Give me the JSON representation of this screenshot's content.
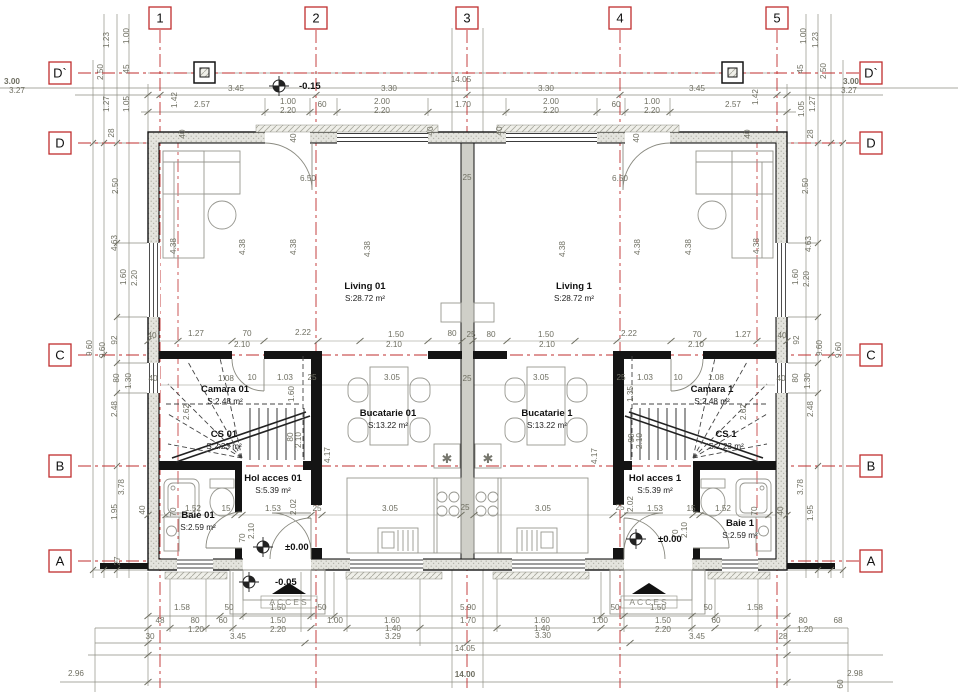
{
  "title": "Ground floor duplex plan",
  "colors": {
    "axis_red": "#bf2e2e",
    "dim_text": "#6f6f62",
    "line_gray": "#8f8f84",
    "wall_black": "#141414",
    "wall_fill": "#e4e4de",
    "furniture": "#979790"
  },
  "grid_axes": {
    "vertical": [
      {
        "label": "1",
        "x": 160
      },
      {
        "label": "2",
        "x": 316
      },
      {
        "label": "3",
        "x": 467
      },
      {
        "label": "4",
        "x": 620
      },
      {
        "label": "5",
        "x": 777
      }
    ],
    "horizontal": [
      {
        "label": "D`",
        "y": 73
      },
      {
        "label": "D",
        "y": 143
      },
      {
        "label": "C",
        "y": 355
      },
      {
        "label": "B",
        "y": 466
      },
      {
        "label": "A",
        "y": 561
      }
    ]
  },
  "rooms": [
    {
      "name": "Living 01",
      "area": "S:28.72 m²",
      "x": 365,
      "y": 289
    },
    {
      "name": "Living 1",
      "area": "S:28.72 m²",
      "x": 574,
      "y": 289
    },
    {
      "name": "Bucatarie 01",
      "area": "S:13.22 m²",
      "x": 388,
      "y": 416
    },
    {
      "name": "Bucatarie 1",
      "area": "S:13.22 m²",
      "x": 547,
      "y": 416
    },
    {
      "name": "Camara 01",
      "area": "S:2.48 m²",
      "x": 225,
      "y": 392
    },
    {
      "name": "Camara 1",
      "area": "S:2.48 m²",
      "x": 712,
      "y": 392
    },
    {
      "name": "CS 01",
      "area": "S:2.23 m²",
      "x": 224,
      "y": 437
    },
    {
      "name": "CS 1",
      "area": "S:2.23 m²",
      "x": 726,
      "y": 437
    },
    {
      "name": "Hol acces 01",
      "area": "S:5.39 m²",
      "x": 273,
      "y": 481
    },
    {
      "name": "Hol acces 1",
      "area": "S:5.39 m²",
      "x": 655,
      "y": 481
    },
    {
      "name": "Baie 01",
      "area": "S:2.59 m²",
      "x": 198,
      "y": 518
    },
    {
      "name": "Baie 1",
      "area": "S:2.59 m²",
      "x": 740,
      "y": 526
    }
  ],
  "levels": [
    {
      "label": "-0.15",
      "x": 299,
      "y": 89,
      "mx": 279,
      "my": 86
    },
    {
      "label": "±0.00",
      "x": 285,
      "y": 550,
      "mx": 263,
      "my": 547
    },
    {
      "label": "±0.00",
      "x": 658,
      "y": 542,
      "mx": 636,
      "my": 539
    },
    {
      "label": "-0.05",
      "x": 275,
      "y": 585,
      "mx": 249,
      "my": 582
    }
  ],
  "access_markers": [
    {
      "label": "ACCES",
      "x": 289,
      "y": 583
    },
    {
      "label": "ACCES",
      "x": 649,
      "y": 583
    }
  ],
  "dims": [
    [
      "3.00",
      12,
      84,
      "b"
    ],
    [
      "3.27",
      17,
      93
    ],
    [
      "3.45",
      236,
      91
    ],
    [
      "3.30",
      389,
      91
    ],
    [
      "14.05",
      461,
      82
    ],
    [
      "3.30",
      546,
      91
    ],
    [
      "3.45",
      697,
      91
    ],
    [
      "3.00",
      851,
      84,
      "b"
    ],
    [
      "3.27",
      849,
      93
    ],
    [
      "2.57",
      202,
      107
    ],
    [
      "1.00",
      288,
      104
    ],
    [
      "2.20",
      288,
      113
    ],
    [
      "60",
      322,
      107
    ],
    [
      "2.00",
      382,
      104
    ],
    [
      "2.20",
      382,
      113
    ],
    [
      "1.70",
      463,
      107
    ],
    [
      "2.00",
      551,
      104
    ],
    [
      "2.20",
      551,
      113
    ],
    [
      "60",
      616,
      107
    ],
    [
      "1.00",
      652,
      104
    ],
    [
      "2.20",
      652,
      113
    ],
    [
      "2.57",
      733,
      107
    ],
    [
      "1.42",
      177,
      100,
      "r"
    ],
    [
      "1.42",
      758,
      97,
      "r"
    ],
    [
      "1.00",
      129,
      36,
      "r"
    ],
    [
      "1.23",
      109,
      40,
      "r"
    ],
    [
      "45",
      129,
      69,
      "r"
    ],
    [
      "2.50",
      103,
      72,
      "r"
    ],
    [
      "1.27",
      109,
      104,
      "r"
    ],
    [
      "1.05",
      129,
      104,
      "r"
    ],
    [
      "28",
      114,
      133,
      "r"
    ],
    [
      "2.50",
      118,
      186,
      "r"
    ],
    [
      "4.63",
      117,
      243,
      "r"
    ],
    [
      "1.60",
      126,
      277,
      "r"
    ],
    [
      "2.20",
      137,
      278,
      "r"
    ],
    [
      "92",
      117,
      340,
      "r"
    ],
    [
      "9.60",
      92,
      348,
      "r"
    ],
    [
      "9.60",
      105,
      350,
      "r"
    ],
    [
      "80",
      119,
      378,
      "r"
    ],
    [
      "1.30",
      131,
      381,
      "r"
    ],
    [
      "2.48",
      117,
      409,
      "r"
    ],
    [
      "3.78",
      124,
      487,
      "r"
    ],
    [
      "1.95",
      117,
      512,
      "r"
    ],
    [
      "27",
      120,
      561,
      "r"
    ],
    [
      "2.96",
      76,
      676
    ],
    [
      "1.00",
      806,
      36,
      "r"
    ],
    [
      "1.23",
      818,
      40,
      "r"
    ],
    [
      "45",
      803,
      69,
      "r"
    ],
    [
      "2.50",
      826,
      71,
      "r"
    ],
    [
      "1.27",
      815,
      104,
      "r"
    ],
    [
      "1.05",
      804,
      109,
      "r"
    ],
    [
      "28",
      813,
      134,
      "r"
    ],
    [
      "2.50",
      808,
      186,
      "r"
    ],
    [
      "4.63",
      811,
      244,
      "r"
    ],
    [
      "1.60",
      798,
      277,
      "r"
    ],
    [
      "2.20",
      809,
      279,
      "r"
    ],
    [
      "92",
      799,
      340,
      "r"
    ],
    [
      "9.60",
      822,
      348,
      "r"
    ],
    [
      "9.60",
      841,
      350,
      "r"
    ],
    [
      "80",
      798,
      378,
      "r"
    ],
    [
      "1.30",
      810,
      381,
      "r"
    ],
    [
      "2.48",
      813,
      409,
      "r"
    ],
    [
      "3.78",
      803,
      487,
      "r"
    ],
    [
      "1.95",
      813,
      513,
      "r"
    ],
    [
      "2.98",
      855,
      676
    ],
    [
      "60",
      843,
      684,
      "r"
    ],
    [
      "40",
      152,
      338
    ],
    [
      "1.27",
      196,
      336
    ],
    [
      "70",
      247,
      336
    ],
    [
      "2.10",
      242,
      347
    ],
    [
      "2.22",
      303,
      335
    ],
    [
      "1.50",
      396,
      337
    ],
    [
      "2.10",
      394,
      347
    ],
    [
      "80",
      452,
      336
    ],
    [
      "25",
      471,
      337
    ],
    [
      "80",
      491,
      337
    ],
    [
      "1.50",
      546,
      337
    ],
    [
      "2.10",
      547,
      347
    ],
    [
      "2.22",
      629,
      336
    ],
    [
      "70",
      697,
      337
    ],
    [
      "2.10",
      696,
      347
    ],
    [
      "1.27",
      743,
      337
    ],
    [
      "40",
      782,
      338
    ],
    [
      "40",
      153,
      381
    ],
    [
      "1.08",
      226,
      381
    ],
    [
      "10",
      252,
      380
    ],
    [
      "1.03",
      285,
      380
    ],
    [
      "25",
      312,
      380
    ],
    [
      "3.05",
      392,
      380
    ],
    [
      "25",
      467,
      381
    ],
    [
      "3.05",
      541,
      380
    ],
    [
      "25",
      621,
      380
    ],
    [
      "1.03",
      645,
      380
    ],
    [
      "10",
      678,
      380
    ],
    [
      "1.08",
      716,
      380
    ],
    [
      "40",
      781,
      381
    ],
    [
      "1.60",
      294,
      394,
      "r"
    ],
    [
      "1.35",
      633,
      394,
      "r"
    ],
    [
      "2.62",
      189,
      412,
      "r"
    ],
    [
      "2.62",
      746,
      412,
      "r"
    ],
    [
      "80",
      293,
      437,
      "r"
    ],
    [
      "2.10",
      301,
      440,
      "r"
    ],
    [
      "80",
      634,
      438,
      "r"
    ],
    [
      "2.10",
      642,
      441,
      "r"
    ],
    [
      "4.17",
      330,
      455,
      "r"
    ],
    [
      "4.17",
      597,
      456,
      "r"
    ],
    [
      "6.50",
      308,
      181
    ],
    [
      "6.50",
      620,
      181
    ],
    [
      "25",
      467,
      180
    ],
    [
      "4.38",
      176,
      246,
      "r"
    ],
    [
      "4.38",
      245,
      247,
      "r"
    ],
    [
      "4.38",
      296,
      247,
      "r"
    ],
    [
      "4.38",
      370,
      249,
      "r"
    ],
    [
      "4.38",
      565,
      249,
      "r"
    ],
    [
      "4.38",
      640,
      247,
      "r"
    ],
    [
      "4.38",
      691,
      247,
      "r"
    ],
    [
      "4.38",
      759,
      246,
      "r"
    ],
    [
      "40",
      185,
      134,
      "r"
    ],
    [
      "40",
      296,
      138,
      "r"
    ],
    [
      "40",
      433,
      131,
      "r"
    ],
    [
      "40",
      502,
      131,
      "r"
    ],
    [
      "40",
      639,
      138,
      "r"
    ],
    [
      "40",
      750,
      134,
      "r"
    ],
    [
      "40",
      145,
      510,
      "r"
    ],
    [
      "70",
      176,
      512,
      "r"
    ],
    [
      "1.52",
      193,
      511
    ],
    [
      "15",
      226,
      511
    ],
    [
      "1.53",
      273,
      511
    ],
    [
      "2.02",
      296,
      507,
      "r"
    ],
    [
      "25",
      317,
      511
    ],
    [
      "3.05",
      390,
      511
    ],
    [
      "25",
      465,
      510
    ],
    [
      "3.05",
      543,
      511
    ],
    [
      "25",
      620,
      510
    ],
    [
      "2.02",
      633,
      504,
      "r"
    ],
    [
      "1.53",
      655,
      511
    ],
    [
      "15",
      691,
      511
    ],
    [
      "1.52",
      723,
      511
    ],
    [
      "70",
      757,
      511,
      "r"
    ],
    [
      "40",
      783,
      511,
      "r"
    ],
    [
      "70",
      245,
      538,
      "r"
    ],
    [
      "2.10",
      254,
      531,
      "r"
    ],
    [
      "70",
      678,
      534,
      "r"
    ],
    [
      "2.10",
      687,
      530,
      "r"
    ],
    [
      "1.58",
      182,
      610
    ],
    [
      "50",
      229,
      610
    ],
    [
      "1.50",
      278,
      610
    ],
    [
      "50",
      322,
      610
    ],
    [
      "5.90",
      468,
      610
    ],
    [
      "50",
      615,
      610
    ],
    [
      "1.50",
      658,
      610
    ],
    [
      "50",
      708,
      610
    ],
    [
      "1.58",
      755,
      610
    ],
    [
      "48",
      160,
      623
    ],
    [
      "80",
      195,
      623
    ],
    [
      "1.20",
      196,
      632
    ],
    [
      "60",
      223,
      623
    ],
    [
      "1.50",
      278,
      623
    ],
    [
      "2.20",
      278,
      632
    ],
    [
      "1.00",
      335,
      623
    ],
    [
      "1.60",
      392,
      623
    ],
    [
      "1.40",
      393,
      631
    ],
    [
      "3.29",
      393,
      639
    ],
    [
      "1.70",
      468,
      623
    ],
    [
      "1.60",
      542,
      623
    ],
    [
      "1.40",
      542,
      631
    ],
    [
      "3.30",
      543,
      638
    ],
    [
      "1.00",
      600,
      623
    ],
    [
      "1.50",
      663,
      623
    ],
    [
      "2.20",
      663,
      632
    ],
    [
      "60",
      716,
      623
    ],
    [
      "80",
      803,
      623
    ],
    [
      "1.20",
      805,
      632
    ],
    [
      "68",
      838,
      623
    ],
    [
      "30",
      150,
      639
    ],
    [
      "3.45",
      238,
      639
    ],
    [
      "3.45",
      697,
      639
    ],
    [
      "28",
      783,
      639
    ],
    [
      "14.05",
      465,
      651
    ],
    [
      "14.00",
      465,
      677,
      "b"
    ]
  ]
}
